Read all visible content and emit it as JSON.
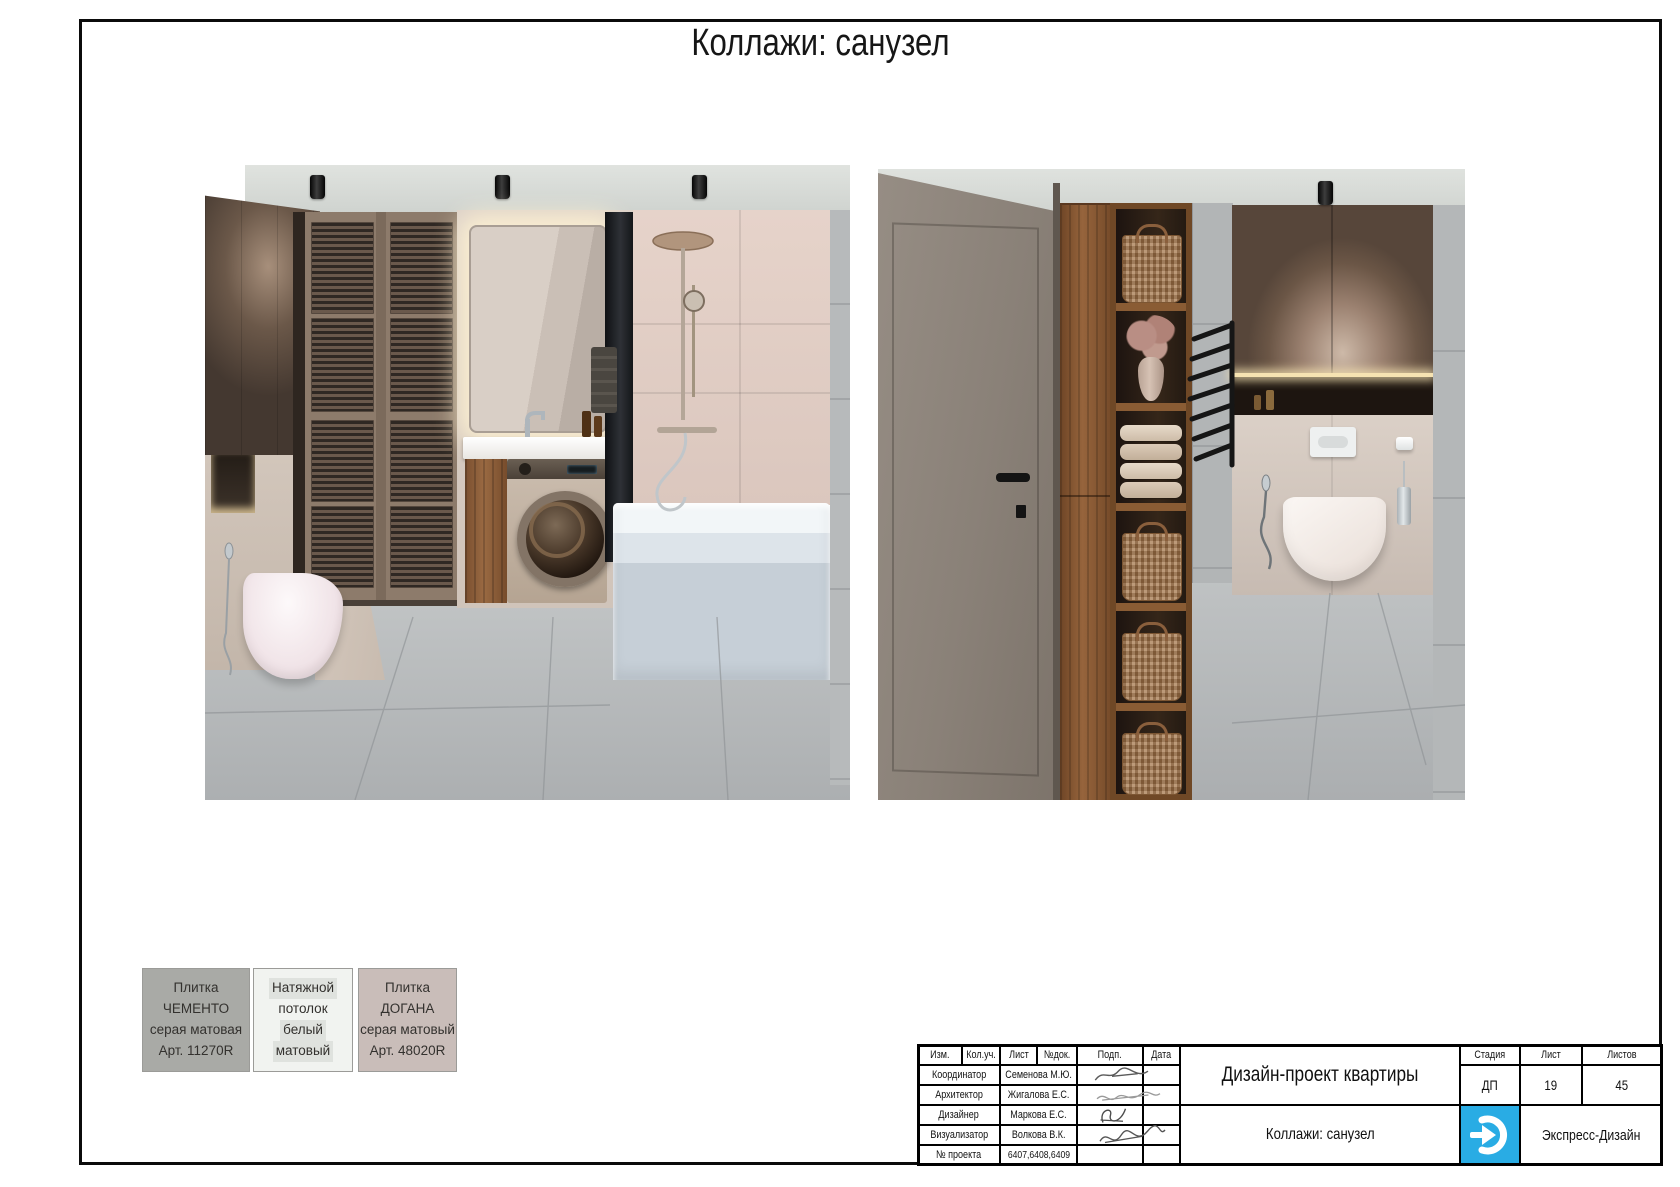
{
  "page": {
    "title": "Коллажи: санузел"
  },
  "swatches": [
    {
      "bg": "#a9aaa6",
      "lines": [
        "Плитка ЧЕМЕНТО",
        "серая матовая",
        "Арт. 11270R"
      ]
    },
    {
      "bg": "#f1f3f0",
      "lines": [
        "Натяжной",
        "потолок",
        "белый",
        "матовый"
      ]
    },
    {
      "bg": "#c9bdb9",
      "lines": [
        "Плитка ДОГАНА",
        "серая матовый",
        "Арт. 48020R"
      ]
    }
  ],
  "stamp": {
    "headers": {
      "izm": "Изм.",
      "koluch": "Кол.уч.",
      "list": "Лист",
      "ndok": "№док.",
      "podp": "Подп.",
      "data": "Дата"
    },
    "rows": [
      {
        "role": "Координатор",
        "name": "Семенова М.Ю."
      },
      {
        "role": "Архитектор",
        "name": "Жигалова Е.С."
      },
      {
        "role": "Дизайнер",
        "name": "Маркова Е.С."
      },
      {
        "role": "Визуализатор",
        "name": "Волкова В.К."
      },
      {
        "role": "№ проекта",
        "name": "6407,6408,6409"
      }
    ],
    "project_title": "Дизайн-проект квартиры",
    "sheet_title": "Коллажи: санузел",
    "stage": {
      "label": "Стадия",
      "value": "ДП"
    },
    "sheet": {
      "label": "Лист",
      "value": "19"
    },
    "sheets": {
      "label": "Листов",
      "value": "45"
    },
    "company": "Экспресс-Дизайн",
    "logo_color": "#29ace4"
  }
}
